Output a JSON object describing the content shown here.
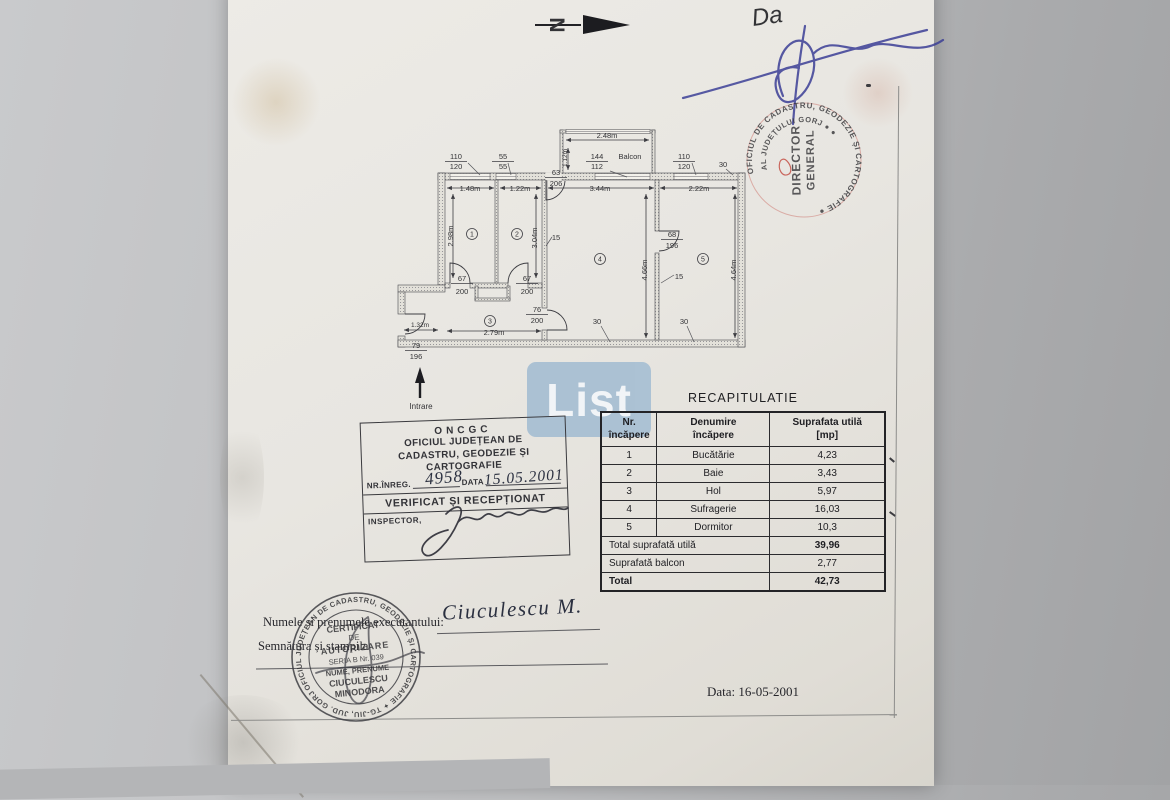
{
  "north": {
    "letter": "N"
  },
  "ink_note": {
    "text": "Da"
  },
  "red_stamp": {
    "ring_outer": "OFICIUL DE CADASTRU, GEODEZIE ȘI CARTOGRAFIE ●",
    "ring_inner": "AL JUDEȚULUI GORJ  ●  ●",
    "center_line1": "DIRECTOR",
    "center_line2": "GENERAL",
    "color": "#c2453b"
  },
  "watermark": {
    "text": "List",
    "bg_color": "#a7bfd3"
  },
  "plan": {
    "entrance_label": "Intrare",
    "rooms": [
      {
        "n": "1",
        "x": 82,
        "y": 116
      },
      {
        "n": "2",
        "x": 127,
        "y": 116
      },
      {
        "n": "3",
        "x": 100,
        "y": 203
      },
      {
        "n": "4",
        "x": 210,
        "y": 141
      },
      {
        "n": "5",
        "x": 313,
        "y": 141
      }
    ],
    "labels": [
      {
        "t": "110",
        "x": 66,
        "y": 41,
        "ul": 1
      },
      {
        "t": "120",
        "x": 66,
        "y": 51
      },
      {
        "t": "55",
        "x": 113,
        "y": 41,
        "ul": 1
      },
      {
        "t": "55",
        "x": 113,
        "y": 51
      },
      {
        "t": "144",
        "x": 207,
        "y": 41,
        "ul": 1
      },
      {
        "t": "Balcon",
        "x": 240,
        "y": 41
      },
      {
        "t": "112",
        "x": 207,
        "y": 51
      },
      {
        "t": "110",
        "x": 294,
        "y": 41,
        "ul": 1
      },
      {
        "t": "120",
        "x": 294,
        "y": 51
      },
      {
        "t": "30",
        "x": 333,
        "y": 49
      },
      {
        "t": "63",
        "x": 166,
        "y": 57,
        "ul": 1
      },
      {
        "t": "206",
        "x": 166,
        "y": 68
      },
      {
        "t": "1.48m",
        "x": 80,
        "y": 73
      },
      {
        "t": "1.22m",
        "x": 130,
        "y": 73
      },
      {
        "t": "3.44m",
        "x": 210,
        "y": 73
      },
      {
        "t": "2.22m",
        "x": 309,
        "y": 73
      },
      {
        "t": "2.48m",
        "x": 217,
        "y": 20
      },
      {
        "t": "1.12m",
        "x": 177,
        "y": 40,
        "r": -90,
        "fs": 6.5
      },
      {
        "t": "2.98m",
        "x": 63,
        "y": 118,
        "r": -90
      },
      {
        "t": "3.04m",
        "x": 147,
        "y": 120,
        "r": -90
      },
      {
        "t": "4.66m",
        "x": 257,
        "y": 152,
        "r": -90
      },
      {
        "t": "4.64m",
        "x": 346,
        "y": 152,
        "r": -90
      },
      {
        "t": "15",
        "x": 166,
        "y": 122
      },
      {
        "t": "68",
        "x": 282,
        "y": 119,
        "ul": 1
      },
      {
        "t": "196",
        "x": 282,
        "y": 130
      },
      {
        "t": "15",
        "x": 289,
        "y": 161
      },
      {
        "t": "67",
        "x": 72,
        "y": 163,
        "ul": 1
      },
      {
        "t": "200",
        "x": 72,
        "y": 176
      },
      {
        "t": "67",
        "x": 137,
        "y": 163,
        "ul": 1
      },
      {
        "t": "200",
        "x": 137,
        "y": 176
      },
      {
        "t": "76",
        "x": 147,
        "y": 194,
        "ul": 1
      },
      {
        "t": "200",
        "x": 147,
        "y": 205
      },
      {
        "t": "30",
        "x": 207,
        "y": 206
      },
      {
        "t": "30",
        "x": 294,
        "y": 206
      },
      {
        "t": "2.79m",
        "x": 104,
        "y": 217
      },
      {
        "t": "1.32m",
        "x": 30,
        "y": 209,
        "fs": 6.5
      },
      {
        "t": "79",
        "x": 26,
        "y": 230,
        "ul": 1
      },
      {
        "t": "196",
        "x": 26,
        "y": 241
      },
      {
        "t": "Intrare",
        "x": 31,
        "y": 291,
        "fs": 8
      }
    ]
  },
  "recap": {
    "title": "RECAPITULATIE",
    "headers": [
      [
        "Nr.",
        "încăpere"
      ],
      [
        "Denumire",
        "încăpere"
      ],
      [
        "Suprafata utilă",
        "[mp]"
      ]
    ],
    "rows": [
      [
        "1",
        "Bucătărie",
        "4,23"
      ],
      [
        "2",
        "Baie",
        "3,43"
      ],
      [
        "3",
        "Hol",
        "5,97"
      ],
      [
        "4",
        "Sufragerie",
        "16,03"
      ],
      [
        "5",
        "Dormitor",
        "10,3"
      ]
    ],
    "summary": [
      [
        "Total suprafată utilă",
        "39,96"
      ],
      [
        "Suprafată balcon",
        "2,77"
      ],
      [
        "Total",
        "42,73"
      ]
    ]
  },
  "oncgc": {
    "org_abbr": "ONCGC",
    "org_line1": "OFICIUL JUDEȚEAN DE",
    "org_line2": "CADASTRU, GEODEZIE ȘI",
    "org_line3": "CARTOGRAFIE",
    "reg_label": "NR.ÎNREG.",
    "reg_value": "4958",
    "date_label": "DATA",
    "date_value": "15.05.2001",
    "verified_line": "VERIFICAT ȘI RECEPȚIONAT",
    "inspector_label": "INSPECTOR,"
  },
  "black_stamp": {
    "ring_text": "OFICIUL JUDEȚEAN DE CADASTRU, GEODEZIE ȘI CARTOGRAFIE ✦ TG-JIU, JUD. GORJ",
    "lines": [
      "CERTIFICAT",
      "DE",
      "AUTORIZARE",
      "SERIA B Nr. 039",
      "NUME, PRENUME",
      "CIUCULESCU",
      "MINODORA"
    ]
  },
  "footer": {
    "executor_label": "Numele si prenumele executantului:",
    "executor_name": "Ciuculescu M.",
    "signature_label": "Semnătura și stampila",
    "date_text": "Data: 16-05-2001"
  }
}
